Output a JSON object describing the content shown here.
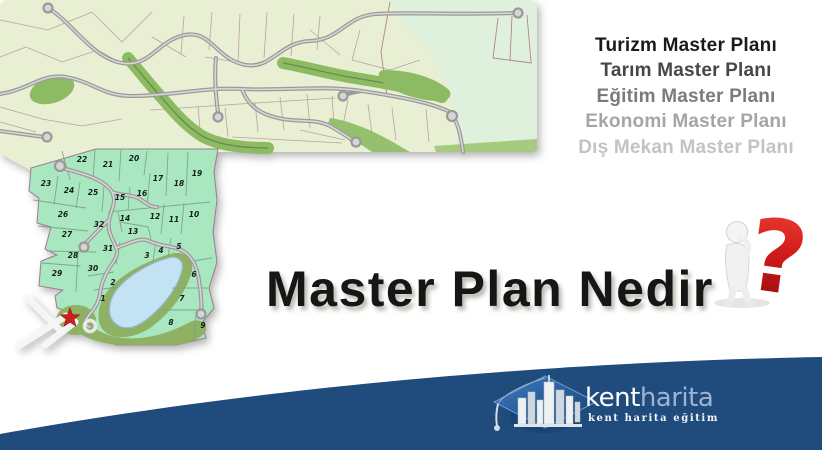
{
  "slide": {
    "title": "Master Plan Nedir",
    "question_mark": "?",
    "plan_list": {
      "items": [
        {
          "label": "Turizm Master Planı",
          "color": "#1a1a1a"
        },
        {
          "label": "Tarım Master Planı",
          "color": "#474747"
        },
        {
          "label": "Eğitim Master Planı",
          "color": "#7b7b7b"
        },
        {
          "label": "Ekonomi Master Planı",
          "color": "#a5a5a5"
        },
        {
          "label": "Dış Mekan Master Planı",
          "color": "#c3c3c3"
        }
      ]
    }
  },
  "map": {
    "lots": [
      {
        "n": "1",
        "x": 103,
        "y": 301
      },
      {
        "n": "2",
        "x": 113,
        "y": 285
      },
      {
        "n": "3",
        "x": 147,
        "y": 258
      },
      {
        "n": "4",
        "x": 161,
        "y": 253
      },
      {
        "n": "5",
        "x": 179,
        "y": 249
      },
      {
        "n": "6",
        "x": 194,
        "y": 277
      },
      {
        "n": "7",
        "x": 182,
        "y": 301
      },
      {
        "n": "8",
        "x": 171,
        "y": 325
      },
      {
        "n": "9",
        "x": 203,
        "y": 328
      },
      {
        "n": "10",
        "x": 194,
        "y": 217
      },
      {
        "n": "11",
        "x": 174,
        "y": 222
      },
      {
        "n": "12",
        "x": 155,
        "y": 219
      },
      {
        "n": "13",
        "x": 133,
        "y": 234
      },
      {
        "n": "14",
        "x": 125,
        "y": 221
      },
      {
        "n": "15",
        "x": 120,
        "y": 200
      },
      {
        "n": "16",
        "x": 142,
        "y": 196
      },
      {
        "n": "17",
        "x": 158,
        "y": 181
      },
      {
        "n": "18",
        "x": 179,
        "y": 186
      },
      {
        "n": "19",
        "x": 197,
        "y": 176
      },
      {
        "n": "20",
        "x": 134,
        "y": 161
      },
      {
        "n": "21",
        "x": 108,
        "y": 167
      },
      {
        "n": "22",
        "x": 82,
        "y": 162
      },
      {
        "n": "23",
        "x": 46,
        "y": 186
      },
      {
        "n": "24",
        "x": 69,
        "y": 193
      },
      {
        "n": "25",
        "x": 93,
        "y": 195
      },
      {
        "n": "26",
        "x": 63,
        "y": 217
      },
      {
        "n": "27",
        "x": 67,
        "y": 237
      },
      {
        "n": "28",
        "x": 73,
        "y": 258
      },
      {
        "n": "29",
        "x": 57,
        "y": 276
      },
      {
        "n": "30",
        "x": 93,
        "y": 271
      },
      {
        "n": "31",
        "x": 108,
        "y": 251
      },
      {
        "n": "32",
        "x": 99,
        "y": 227
      }
    ],
    "colors": {
      "pale_left": "#e9efd2",
      "pale_right": "#dff0dc",
      "parcel_green": "#a9e7c0",
      "greenway": "#8cbb63",
      "olive": "#8fb164",
      "lake": "#c3e2f4",
      "road": "#9a9a9a",
      "star": "#cf1f1f"
    }
  },
  "footer": {
    "band_color": "#1f4b7d",
    "logo": {
      "brand_primary": "kent",
      "brand_secondary": "harita",
      "tagline": "kent harita eğitim"
    }
  }
}
